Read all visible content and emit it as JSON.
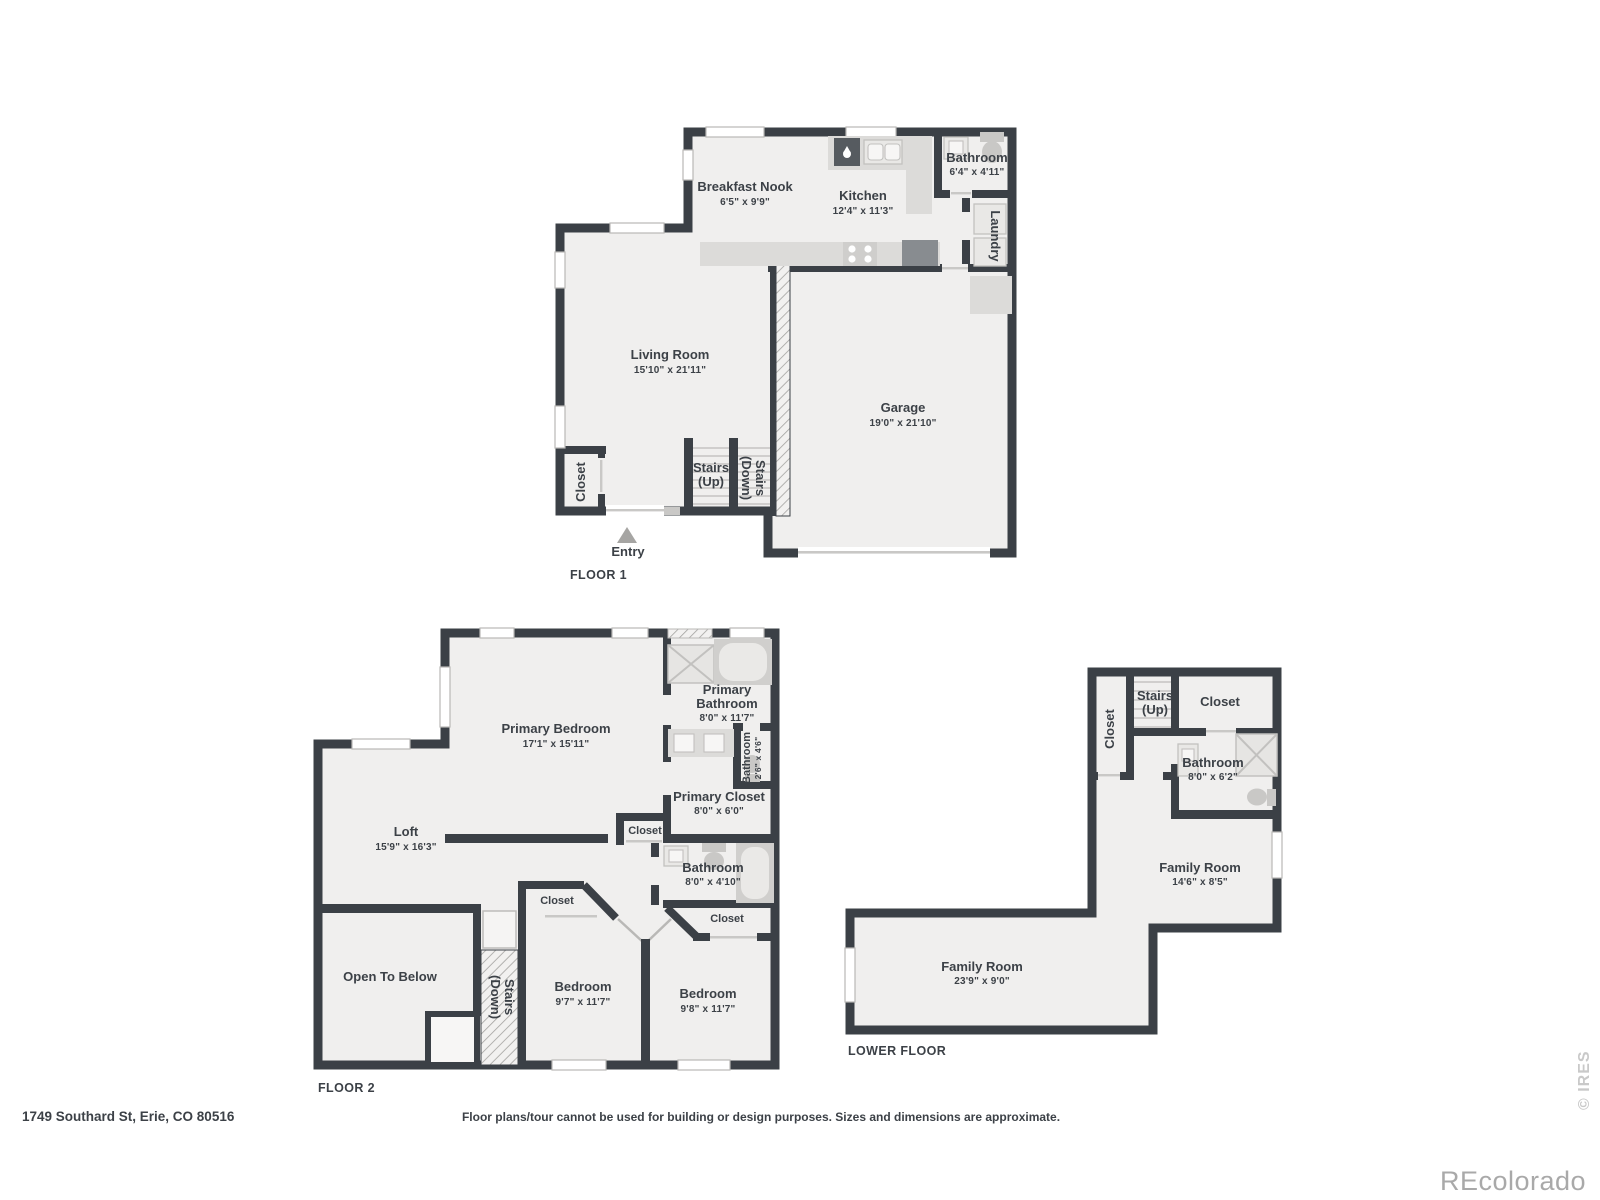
{
  "address": "1749 Southard St, Erie, CO 80516",
  "disclaimer": "Floor plans/tour cannot be used for building or design purposes. Sizes and dimensions are approximate.",
  "watermark": {
    "brand": "REcolorado",
    "ires": "© IRES"
  },
  "colors": {
    "wall": "#3b4046",
    "room_fill": "#f0efee",
    "fixture": "#dcdbd9",
    "text": "#3c4147",
    "watermark": "#a9a9a9"
  },
  "floor1": {
    "label": "FLOOR 1",
    "entry": "Entry",
    "rooms": {
      "breakfast_nook": {
        "name": "Breakfast Nook",
        "dims": "6'5\" x 9'9\""
      },
      "kitchen": {
        "name": "Kitchen",
        "dims": "12'4\" x 11'3\""
      },
      "bathroom": {
        "name": "Bathroom",
        "dims": "6'4\" x 4'11\""
      },
      "laundry": {
        "name": "Laundry"
      },
      "living_room": {
        "name": "Living Room",
        "dims": "15'10\" x 21'11\""
      },
      "garage": {
        "name": "Garage",
        "dims": "19'0\" x 21'10\""
      },
      "closet": {
        "name": "Closet"
      },
      "stairs_up": {
        "name": "Stairs",
        "sub": "(Up)"
      },
      "stairs_down": {
        "name": "Stairs",
        "sub": "(Down)"
      }
    }
  },
  "floor2": {
    "label": "FLOOR 2",
    "rooms": {
      "primary_bedroom": {
        "name": "Primary Bedroom",
        "dims": "17'1\" x 15'11\""
      },
      "primary_bathroom": {
        "name1": "Primary",
        "name2": "Bathroom",
        "dims": "8'0\" x 11'7\""
      },
      "bathroom_small": {
        "name": "Bathroom",
        "dims": "2'6\" x 4'6\""
      },
      "primary_closet": {
        "name": "Primary Closet",
        "dims": "8'0\" x 6'0\""
      },
      "closet_hall": {
        "name": "Closet"
      },
      "loft": {
        "name": "Loft",
        "dims": "15'9\" x 16'3\""
      },
      "bathroom": {
        "name": "Bathroom",
        "dims": "8'0\" x 4'10\""
      },
      "closet_bedroom1": {
        "name": "Closet"
      },
      "closet_bedroom2": {
        "name": "Closet"
      },
      "open_to_below": {
        "name": "Open To Below"
      },
      "stairs_down": {
        "name": "Stairs",
        "sub": "(Down)"
      },
      "bedroom1": {
        "name": "Bedroom",
        "dims": "9'7\" x 11'7\""
      },
      "bedroom2": {
        "name": "Bedroom",
        "dims": "9'8\" x 11'7\""
      }
    }
  },
  "lower": {
    "label": "LOWER FLOOR",
    "rooms": {
      "closet_left": {
        "name": "Closet"
      },
      "stairs_up": {
        "name": "Stairs",
        "sub": "(Up)"
      },
      "closet": {
        "name": "Closet"
      },
      "bathroom": {
        "name": "Bathroom",
        "dims": "8'0\" x 6'2\""
      },
      "family_room_upper": {
        "name": "Family Room",
        "dims": "14'6\" x 8'5\""
      },
      "family_room": {
        "name": "Family Room",
        "dims": "23'9\" x 9'0\""
      }
    }
  }
}
